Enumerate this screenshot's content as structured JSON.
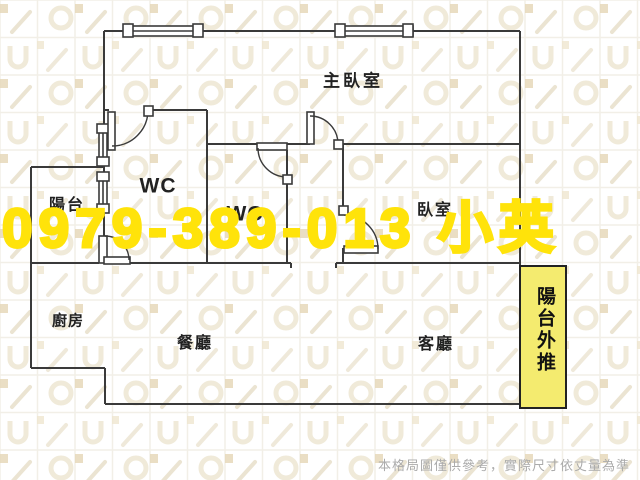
{
  "watermark": {
    "text": "0979-389-013 小英",
    "color": "#FFE30A"
  },
  "rooms": {
    "master_bedroom": {
      "label": "主臥室"
    },
    "wc1": {
      "label": "WC"
    },
    "wc2": {
      "label": "WC"
    },
    "balcony": {
      "label": "陽台"
    },
    "bedroom": {
      "label": "臥室"
    },
    "kitchen": {
      "label": "廚房"
    },
    "dining": {
      "label": "餐廳"
    },
    "living": {
      "label": "客廳"
    },
    "storage_note": {
      "label": "儲藏"
    }
  },
  "balcony_extension": {
    "label": "陽台外推",
    "fill": "#F4EB6F",
    "border": "#222222"
  },
  "plan": {
    "wall_color": "#3a3a3a"
  },
  "disclaimer": {
    "text": "本格局圖僅供參考，實際尺寸依丈量為準",
    "color": "#ABABAB"
  }
}
